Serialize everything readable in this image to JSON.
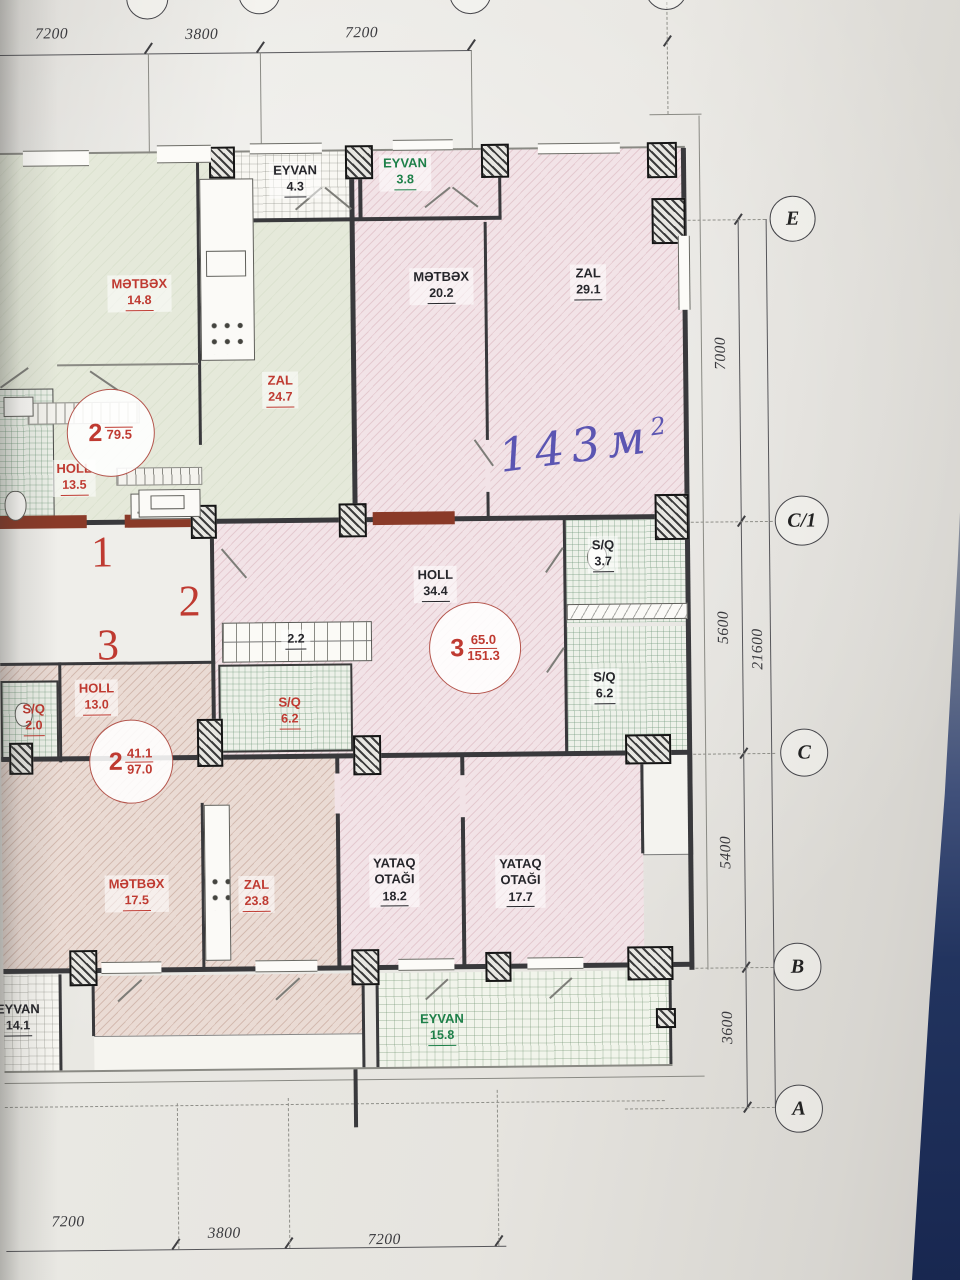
{
  "colors": {
    "red": "#bf3a31",
    "green": "#1e8049",
    "black": "#26262b",
    "ink": "#5b55b2",
    "maroon": "#8a3a28",
    "paper": "#e7e5e0",
    "blue_bg": "#22345f"
  },
  "dims": {
    "top": [
      "7200",
      "3800",
      "7200"
    ],
    "bottom": [
      "7200",
      "3800",
      "7200"
    ],
    "right": [
      "7000",
      "5600",
      "5400",
      "3600"
    ],
    "total": "21600"
  },
  "axes": {
    "e": "E",
    "c1": "C/1",
    "c": "C",
    "b": "B",
    "a": "A"
  },
  "stairwell": {
    "n1": "1",
    "n2": "2",
    "n3": "3"
  },
  "apartments": {
    "apt2_top": {
      "number": "2",
      "area_top": "",
      "area_bottom": "79.5"
    },
    "apt3": {
      "number": "3",
      "area_top": "65.0",
      "area_bottom": "151.3"
    },
    "apt2_bottom": {
      "number": "2",
      "area_top": "41.1",
      "area_bottom": "97.0"
    }
  },
  "rooms": {
    "eyvan_tl": {
      "name": "EYVAN",
      "area": "4.3"
    },
    "eyvan_tr": {
      "name": "EYVAN",
      "area": "3.8"
    },
    "metbex_tl": {
      "name": "MƏTBƏX",
      "area": "14.8"
    },
    "zal_tl": {
      "name": "ZAL",
      "area": "24.7"
    },
    "holl_tl": {
      "name": "HOLL",
      "area": "13.5"
    },
    "metbex_tr": {
      "name": "MƏTBƏX",
      "area": "20.2"
    },
    "zal_tr": {
      "name": "ZAL",
      "area": "29.1"
    },
    "holl_mid": {
      "name": "HOLL",
      "area": "34.4"
    },
    "sq_tr": {
      "name": "S/Q",
      "area": "3.7"
    },
    "sq_r": {
      "name": "S/Q",
      "area": "6.2"
    },
    "strip": {
      "area": "2.2"
    },
    "holl_bl": {
      "name": "HOLL",
      "area": "13.0"
    },
    "sq_small": {
      "name": "S/Q",
      "area": "2.0"
    },
    "sq_l": {
      "name": "S/Q",
      "area": "6.2"
    },
    "metbex_b": {
      "name": "MƏTBƏX",
      "area": "17.5"
    },
    "zal_b": {
      "name": "ZAL",
      "area": "23.8"
    },
    "yataq1": {
      "name_line1": "YATAQ",
      "name_line2": "OTAĞI",
      "area": "18.2"
    },
    "yataq2": {
      "name_line1": "YATAQ",
      "name_line2": "OTAĞI",
      "area": "17.7"
    },
    "eyvan_bl": {
      "name": "EYVAN",
      "area": "14.1"
    },
    "eyvan_b": {
      "name": "EYVAN",
      "area": "15.8"
    }
  },
  "handwriting": {
    "value": "143",
    "unit": "м",
    "sup": "2"
  }
}
